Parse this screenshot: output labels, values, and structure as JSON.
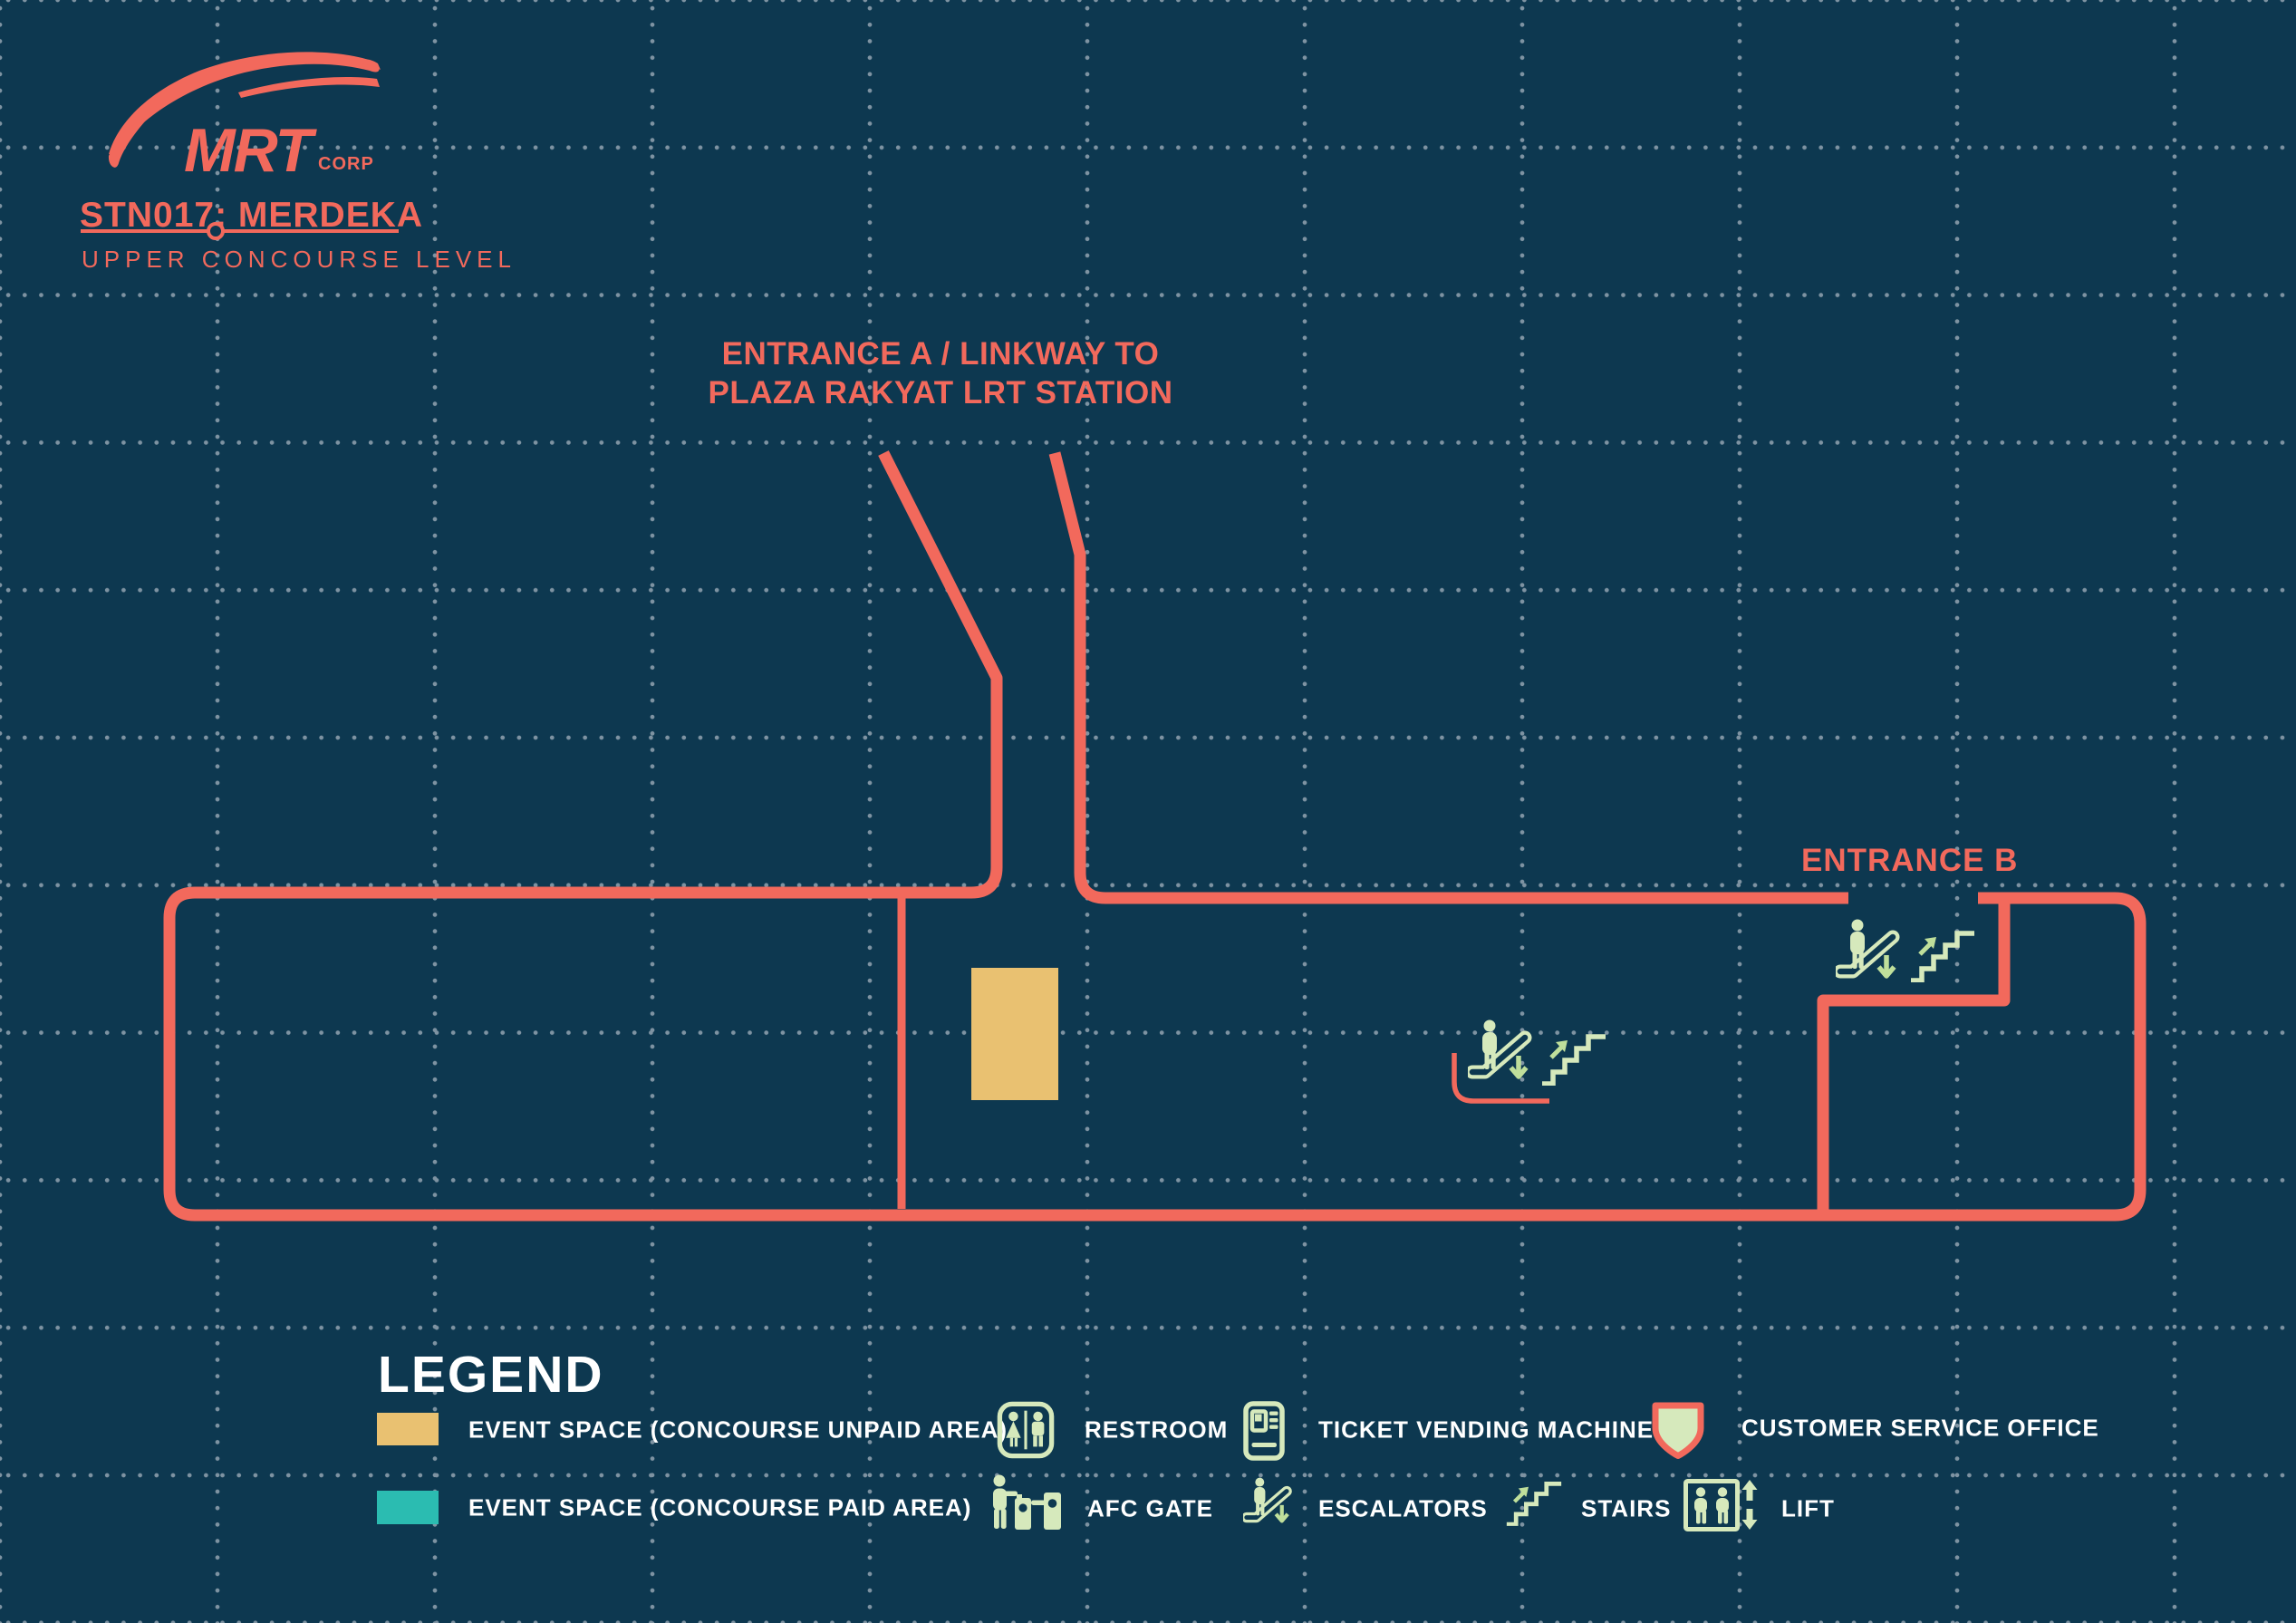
{
  "colors": {
    "bg": "#0d3850",
    "coral": "#f2695c",
    "mint": "#d6e9bc",
    "arrow": "#bfdf9b",
    "orange": "#e9c171",
    "teal": "#2bbcb1",
    "label-text": "#ffffff",
    "grid-dot": "#7e93a2"
  },
  "header": {
    "logo_main": "MRT",
    "logo_sub": "CORP",
    "station_code_name": "STN017: MERDEKA",
    "level_name": "UPPER CONCOURSE LEVEL"
  },
  "map": {
    "entrance_a_line1": "ENTRANCE A / LINKWAY TO",
    "entrance_a_line2": "PLAZA RAKYAT LRT STATION",
    "entrance_b": "ENTRANCE B",
    "features": {
      "event_space_unpaid": "Event space rectangle in concourse unpaid area",
      "center_vertical_circulation": "Down escalator and up stairs near concourse center",
      "entrance_b_vertical_circulation": "Down escalator and up stairs at Entrance B vestibule"
    }
  },
  "legend": {
    "title": "LEGEND",
    "items": [
      {
        "icon": "event-space-unpaid-swatch",
        "label": "EVENT SPACE (CONCOURSE UNPAID AREA)",
        "color": "#e9c171"
      },
      {
        "icon": "restroom-icon",
        "label": "RESTROOM"
      },
      {
        "icon": "ticket-vending-machine-icon",
        "label": "TICKET VENDING MACHINE"
      },
      {
        "icon": "customer-service-office-icon",
        "label": "CUSTOMER SERVICE OFFICE"
      },
      {
        "icon": "event-space-paid-swatch",
        "label": "EVENT SPACE (CONCOURSE PAID AREA)",
        "color": "#2bbcb1"
      },
      {
        "icon": "afc-gate-icon",
        "label": "AFC GATE"
      },
      {
        "icon": "escalators-icon",
        "label": "ESCALATORS"
      },
      {
        "icon": "stairs-icon",
        "label": "STAIRS"
      },
      {
        "icon": "lift-icon",
        "label": "LIFT"
      }
    ]
  }
}
